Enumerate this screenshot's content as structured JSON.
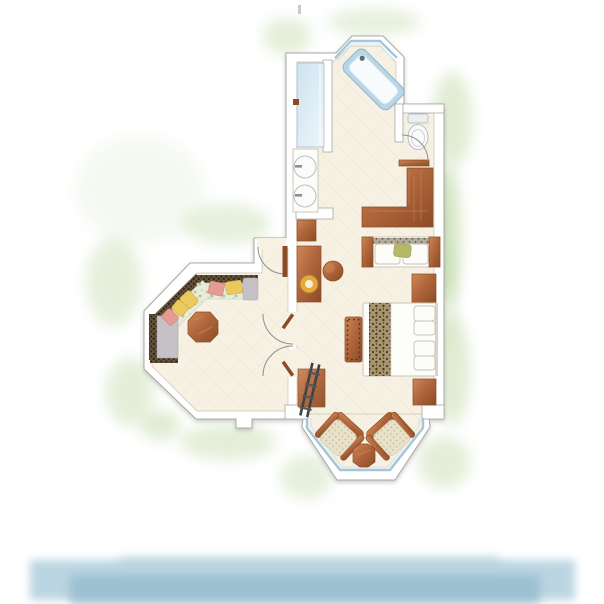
{
  "canvas": {
    "width": 604,
    "height": 604
  },
  "scene": {
    "kind": "watercolor-style resort suite floor plan, top-down illustration",
    "surroundings": "soft green foliage wash hugging the building outline",
    "waterfront": "pale blue watercolor water band along the bottom edge",
    "text_visible": "none"
  },
  "rooms": [
    {
      "id": "bathroom",
      "label": "bathroom",
      "features": [
        "angled window bay with corner bathtub",
        "glass shower stall with door handle",
        "double vanity with two round basins",
        "toilet nook with swing door and wooden threshold"
      ]
    },
    {
      "id": "dressing-area",
      "label": "dressing area",
      "features": [
        "L-shaped wooden wardrobe counter",
        "white bench with two cushions and green pillow"
      ]
    },
    {
      "id": "bedroom",
      "label": "bedroom",
      "features": [
        "double bed with leopard-print runner and four pillows",
        "two wooden nightstands",
        "writing desk with round gold lamp",
        "round wooden stool",
        "studded wooden bench at bed foot",
        "dark ladder rack on wooden mat"
      ]
    },
    {
      "id": "lounge",
      "label": "octagonal lounge",
      "features": [
        "corner sofa with dark speckled back and floral seat",
        "yellow and pink throw pillows",
        "gray chaise end",
        "hexagonal wooden coffee table",
        "double swing doors to bedroom",
        "entrance door from outside"
      ]
    },
    {
      "id": "bay-nook",
      "label": "bay window nook",
      "features": [
        "two wicker armchairs with wooden frames",
        "octagonal wooden side table",
        "wrap-around bay windows"
      ]
    }
  ],
  "colors": {
    "wall_fill": "#ffffff",
    "wall_stroke": "#a8a8a6",
    "floor": "#f6f1e3",
    "tile_line": "#e4dcc8",
    "wood": "#b1663c",
    "wood_dark": "#8a4c26",
    "wood_light": "#cf8757",
    "window_blue": "#9fc4da",
    "glass_blue_1": "#cde3f0",
    "glass_blue_2": "#eef6fa",
    "tub_rim": "#b7d6e8",
    "leopard_base": "#a7956f",
    "leopard_dot": "#4f3b22",
    "speck_base": "#b3aa99",
    "speck_dot": "#645b4d",
    "sofa_back": "#63523a",
    "sofa_back_dot": "#2c2212",
    "sofa_seat": "#e7ecdb",
    "pillow_yellow": "#eac95e",
    "pillow_pink": "#e69a94",
    "pillow_green": "#b4b867",
    "chaise_gray": "#c6c0c7",
    "wicker": "#e9e2cb",
    "wicker_dot": "#c7b98f",
    "green_wash": "#cde1b9",
    "green_deep": "#b9d5a0",
    "water": "#afcedd",
    "water_deep": "#95bbcd",
    "lamp_gold": "#e3a93d",
    "lamp_inner": "#f8eed8",
    "dark_obj": "#3f4246",
    "white_item": "#fcfcf9",
    "item_stroke": "#c7c2b6",
    "porcelain_stroke": "#b8bfc3"
  }
}
